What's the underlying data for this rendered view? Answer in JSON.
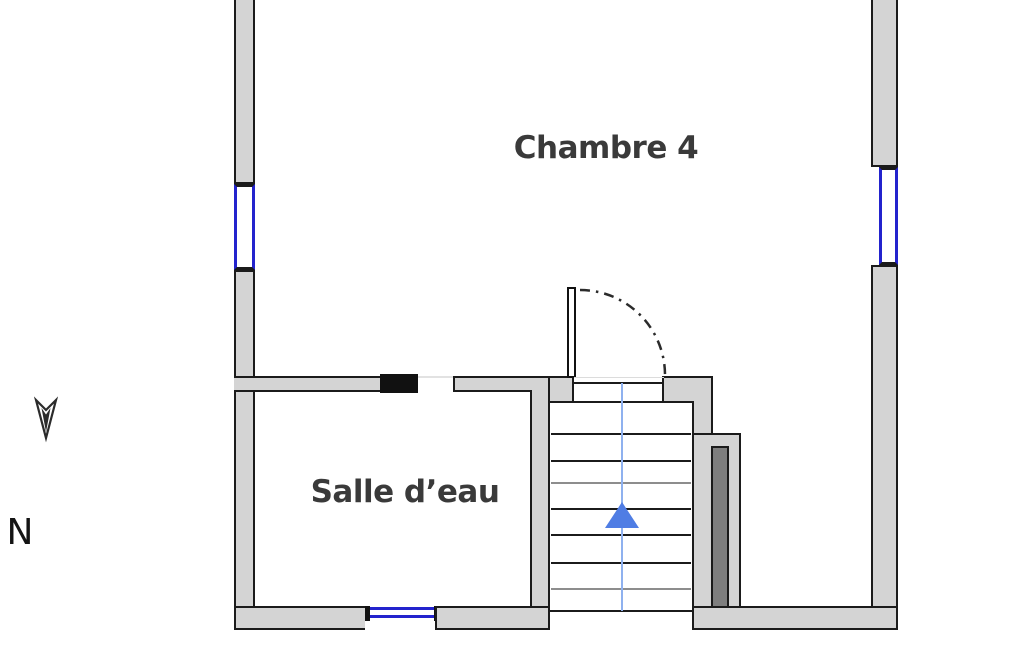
{
  "floorplan": {
    "rooms": [
      {
        "label": "Chambre 4"
      },
      {
        "label": "Salle d’eau"
      }
    ],
    "compass": {
      "label": "N"
    },
    "stairs": {
      "step_count": 8,
      "direction": "up"
    },
    "windows": {
      "count": 3
    },
    "colors": {
      "canvas_bg": "#ffffff",
      "wall_fill": "#d4d4d4",
      "wall_outline": "#1b1b1b",
      "window_blue": "#2323cd",
      "step_light": "#8d8d8d",
      "guide_blue": "#8fb1ef",
      "arrow_blue": "#4f7de4",
      "duct_fill": "#7e7e7e",
      "label_color": "#3a3a3a"
    }
  }
}
